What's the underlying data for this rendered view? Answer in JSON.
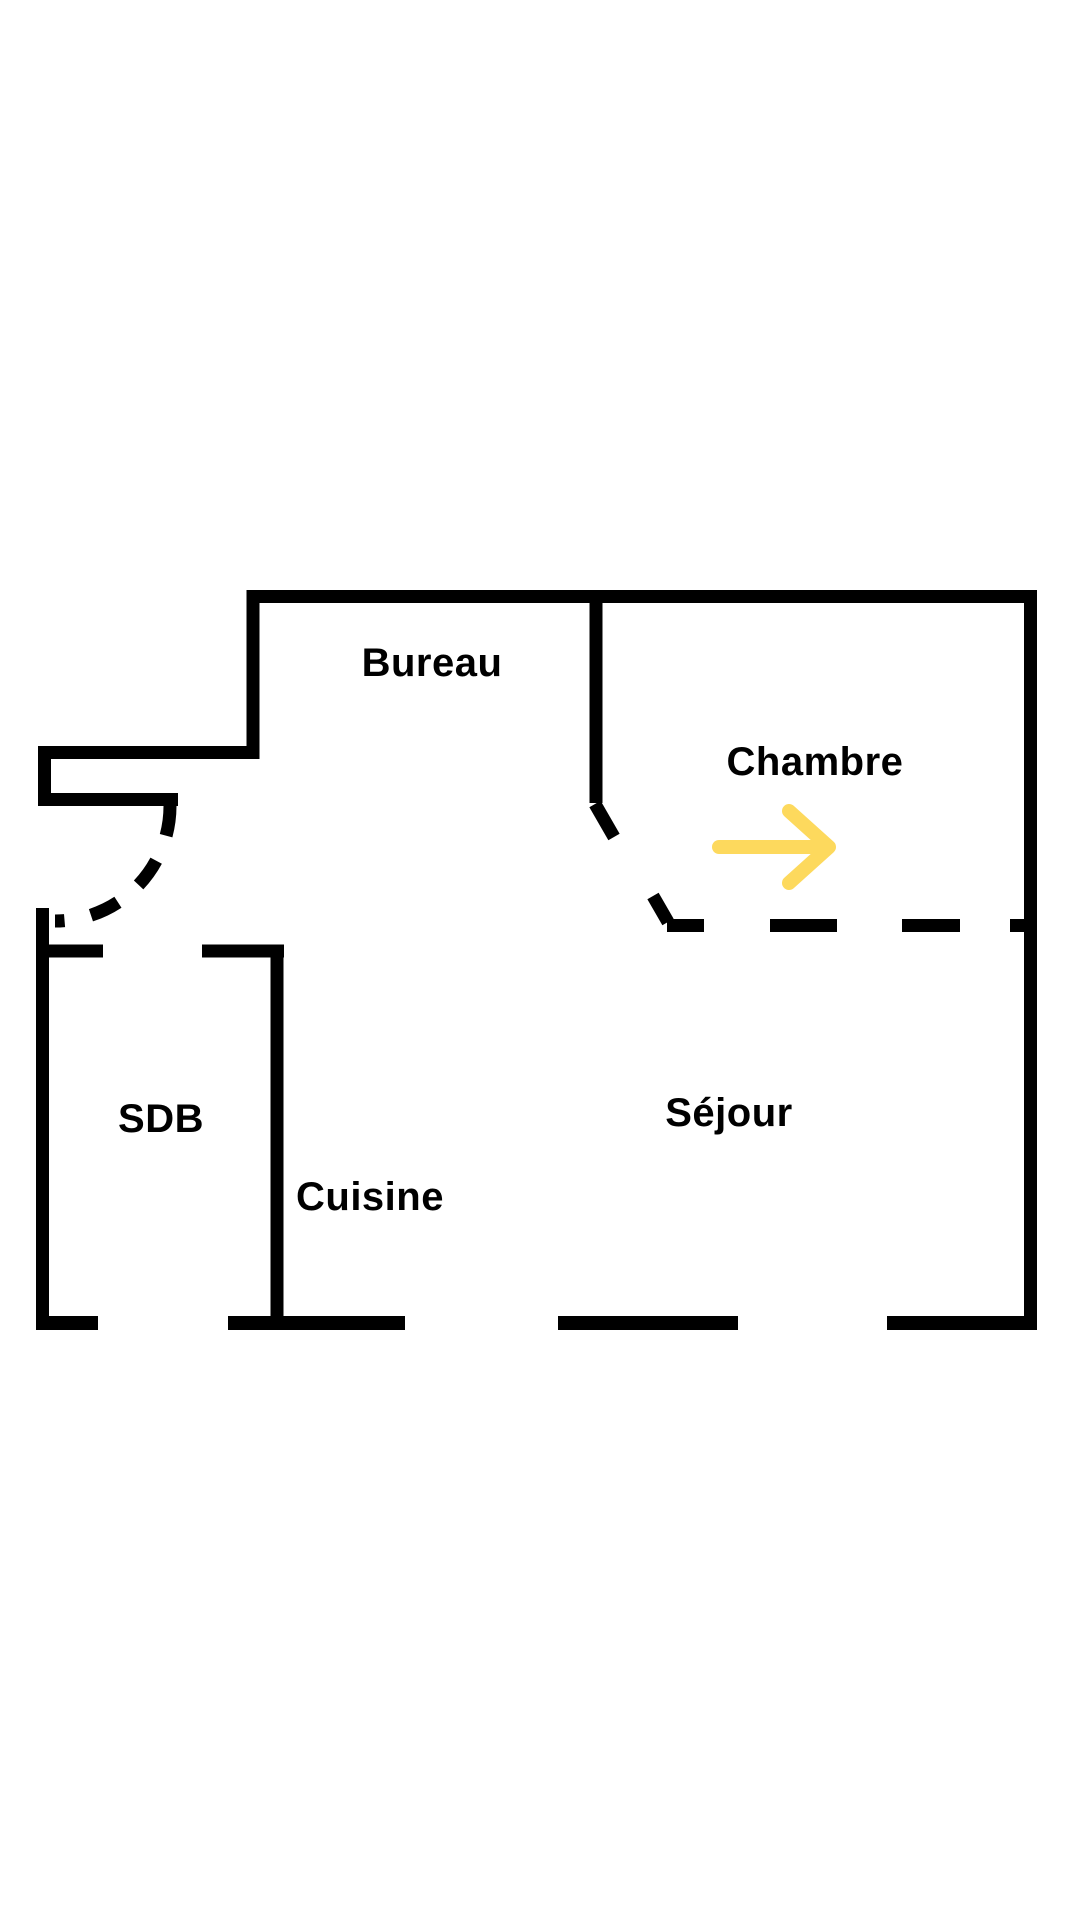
{
  "diagram": {
    "type": "floor-plan",
    "colors": {
      "background": "#ffffff",
      "walls": "#000000",
      "arrow": "#fdd95d"
    },
    "rooms": [
      {
        "id": "bureau",
        "label": "Bureau"
      },
      {
        "id": "chambre",
        "label": "Chambre"
      },
      {
        "id": "sdb",
        "label": "SDB"
      },
      {
        "id": "cuisine",
        "label": "Cuisine"
      },
      {
        "id": "sejour",
        "label": "Séjour"
      }
    ],
    "arrow": {
      "direction": "right"
    }
  }
}
